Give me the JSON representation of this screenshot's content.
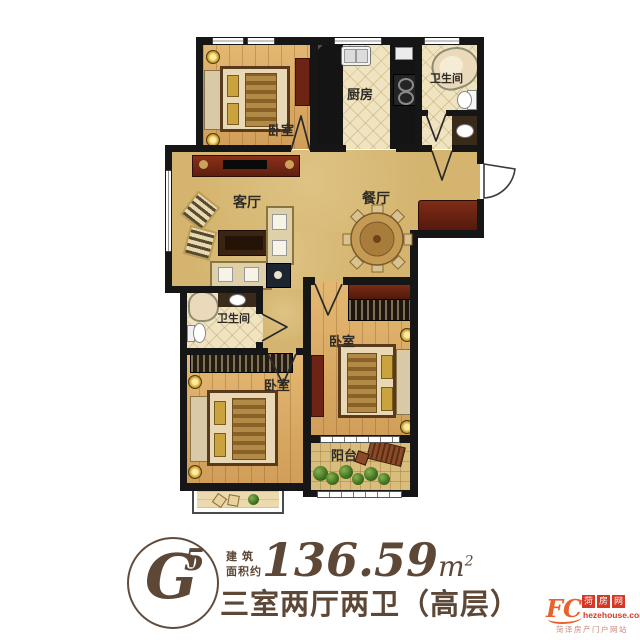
{
  "rooms": {
    "bedroom_top_left": {
      "label": "卧室"
    },
    "kitchen": {
      "label": "厨房"
    },
    "bathroom_top": {
      "label": "卫生间"
    },
    "living_room": {
      "label": "客厅"
    },
    "dining_room": {
      "label": "餐厅"
    },
    "bathroom_middle": {
      "label": "卫生间"
    },
    "bedroom_right": {
      "label": "卧室"
    },
    "bedroom_bottom_left": {
      "label": "卧室"
    },
    "balcony": {
      "label": "阳台"
    }
  },
  "footer": {
    "unit_letter": "G",
    "unit_number": "5",
    "area_label_line1": "建 筑",
    "area_label_line2": "面积约",
    "area_value": "136.59",
    "area_unit": "m",
    "area_unit_exponent": "2",
    "layout_description": "三室两厅两卫（高层）"
  },
  "watermark": {
    "logo": "FC",
    "site_name_chars": [
      "菏",
      "房",
      "网"
    ],
    "url": "hezehouse.com",
    "tagline": "菏泽房产门户网站"
  },
  "colors": {
    "wall": "#161616",
    "floor_main": "#d4b46e",
    "floor_wood": "#dcaa62",
    "floor_tile": "#f0e3c0",
    "cabinet_red": "#6e2415",
    "text_brown": "#5d4736",
    "watermark_red": "#d43926",
    "watermark_orange": "#e8622d"
  }
}
